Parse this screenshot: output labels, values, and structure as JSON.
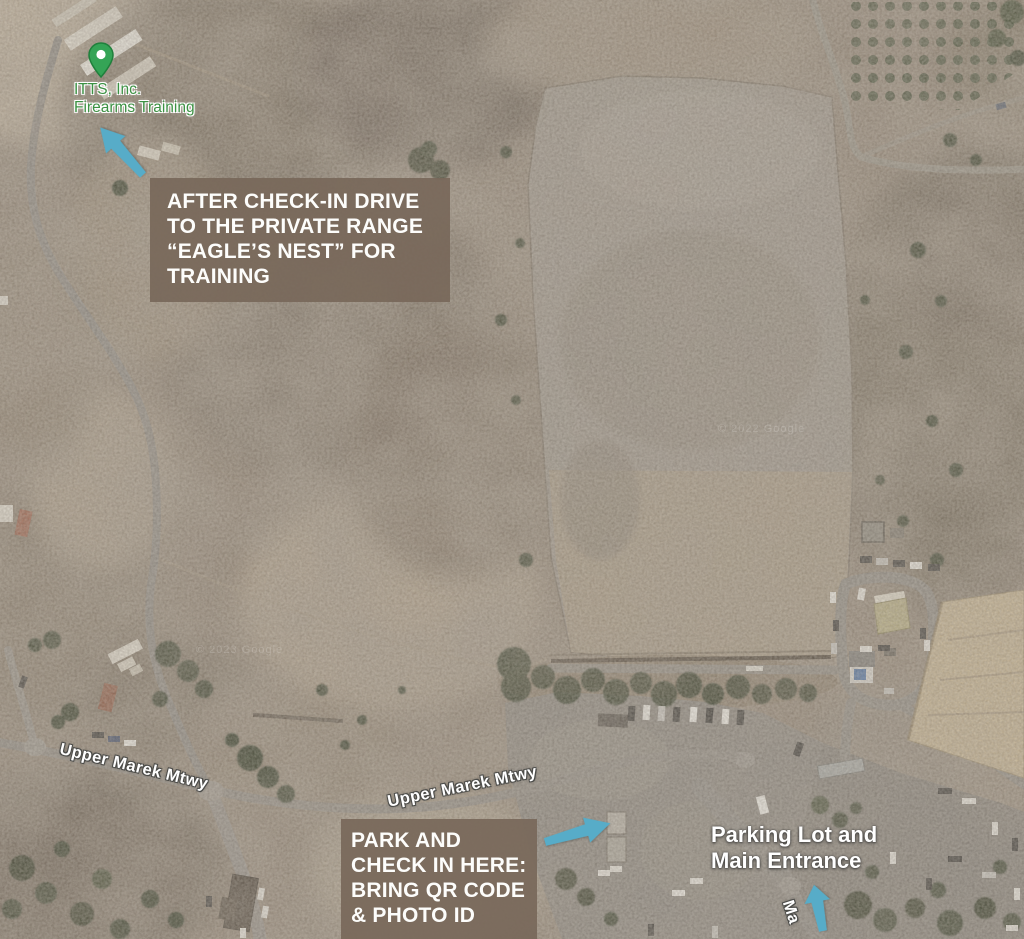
{
  "annotations": {
    "place_pin": {
      "label_line1": "ITTS, Inc.",
      "label_line2": "Firearms Training"
    },
    "callout_eagles_nest": {
      "lines": [
        "AFTER CHECK-IN DRIVE",
        "TO THE PRIVATE RANGE",
        "“EAGLE’S NEST” FOR",
        "TRAINING"
      ]
    },
    "callout_park": {
      "lines": [
        "PARK AND",
        "CHECK IN HERE:",
        "BRING QR CODE",
        "& PHOTO ID"
      ]
    },
    "parking_entrance": {
      "lines": [
        "Parking Lot and",
        "Main Entrance"
      ]
    }
  },
  "road_labels": {
    "west": "Upper Marek Mtwy",
    "east": "Upper Marek Mtwy",
    "south_partial": "Ma"
  },
  "watermarks": {
    "west": "© 2023 Google",
    "east": "© 2022 Google"
  },
  "colors": {
    "callout_bg": "#78685a",
    "arrow_blue": "#57acc8",
    "pin_green": "#35a456",
    "place_label_green": "#3c9143",
    "road_label_white": "#ffffff"
  }
}
